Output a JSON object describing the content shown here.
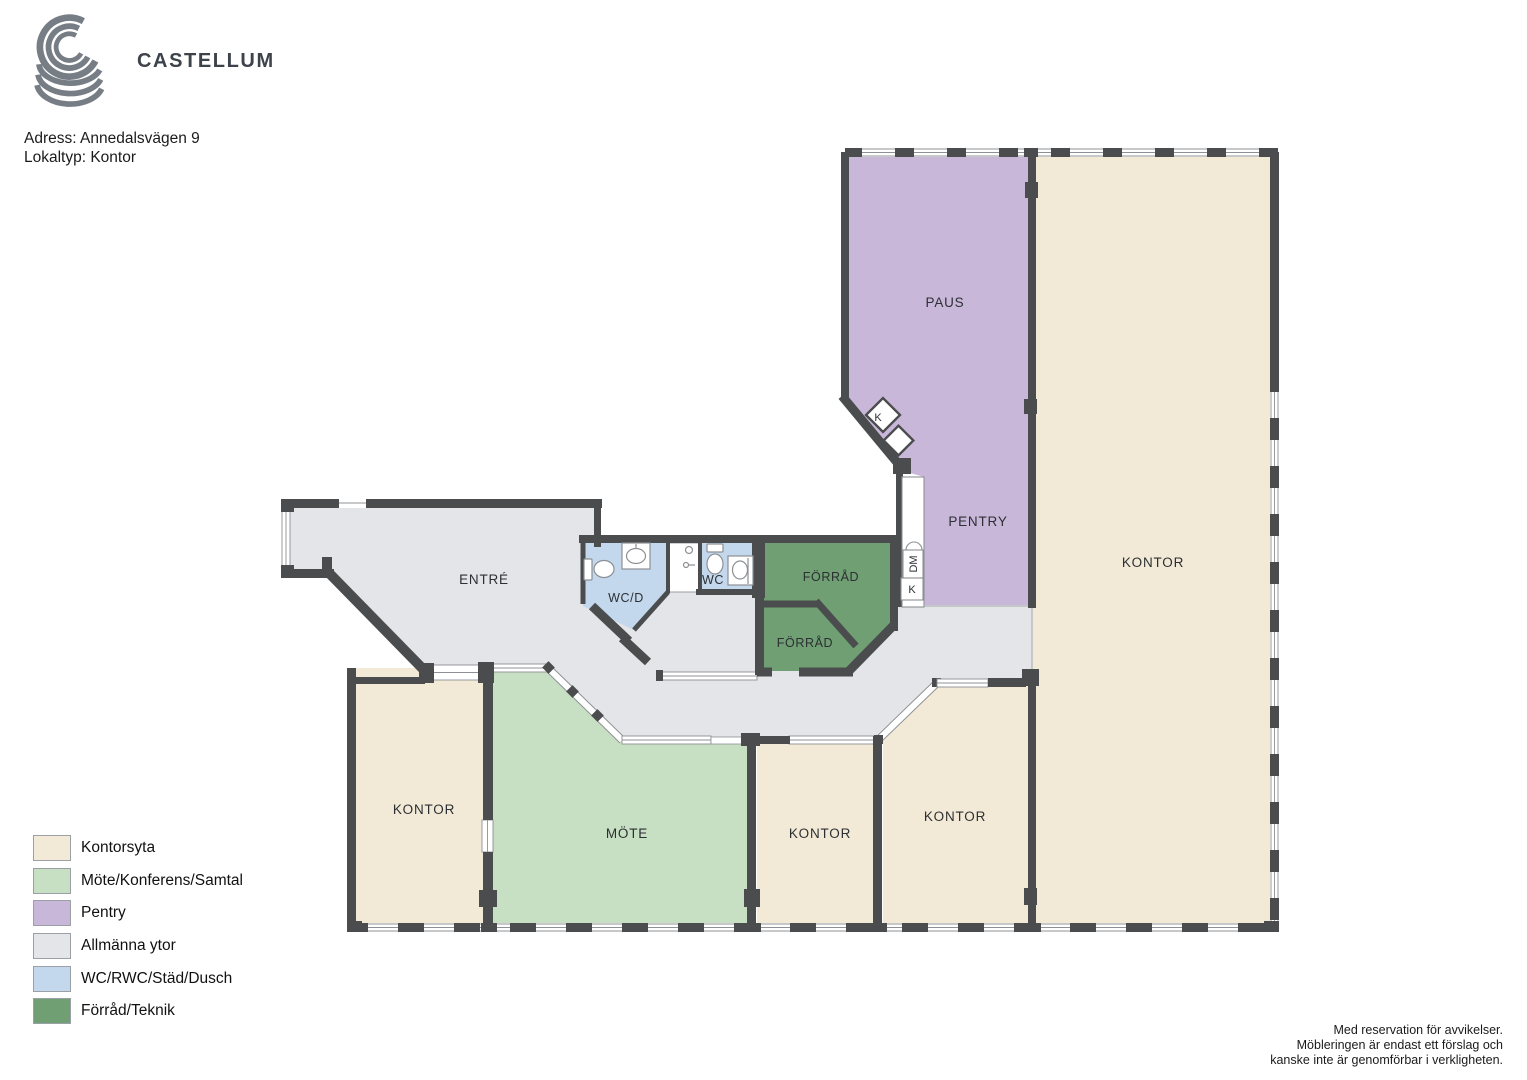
{
  "header": {
    "brand": "CASTELLUM",
    "address_line": "Adress: Annedalsvägen 9",
    "type_line": "Lokaltyp: Kontor"
  },
  "plan": {
    "labels": {
      "paus": "PAUS",
      "pentry": "PENTRY",
      "kontor_main": "KONTOR",
      "entre": "ENTRÉ",
      "wcd": "WC/D",
      "wc": "WC",
      "forrad_big": "FÖRRÅD",
      "forrad_small": "FÖRRÅD",
      "kontor_sw": "KONTOR",
      "mote": "MÖTE",
      "kontor_s_mid": "KONTOR",
      "kontor_s_right": "KONTOR"
    },
    "fixtures": {
      "kitchen_diamond": "K",
      "dishwasher": "DM",
      "counter_k": "K"
    },
    "colors": {
      "office": "#f2ead7",
      "meeting": "#c7dfc2",
      "pantry": "#c9b7da",
      "common": "#e3e5e8",
      "wc": "#c3d8ed",
      "storage": "#6f9f73",
      "wall": "#4a4c4e"
    }
  },
  "legend": {
    "items": [
      {
        "label": "Kontorsyta",
        "color": "#f2ead7"
      },
      {
        "label": "Möte/Konferens/Samtal",
        "color": "#c7dfc2"
      },
      {
        "label": "Pentry",
        "color": "#c9b7da"
      },
      {
        "label": "Allmänna ytor",
        "color": "#e3e5e8"
      },
      {
        "label": "WC/RWC/Städ/Dusch",
        "color": "#c3d8ed"
      },
      {
        "label": "Förråd/Teknik",
        "color": "#6f9f73"
      }
    ]
  },
  "disclaimer": {
    "line1": "Med reservation för avvikelser.",
    "line2": "Möbleringen är endast ett förslag och",
    "line3": "kanske inte är genomförbar i verkligheten."
  }
}
